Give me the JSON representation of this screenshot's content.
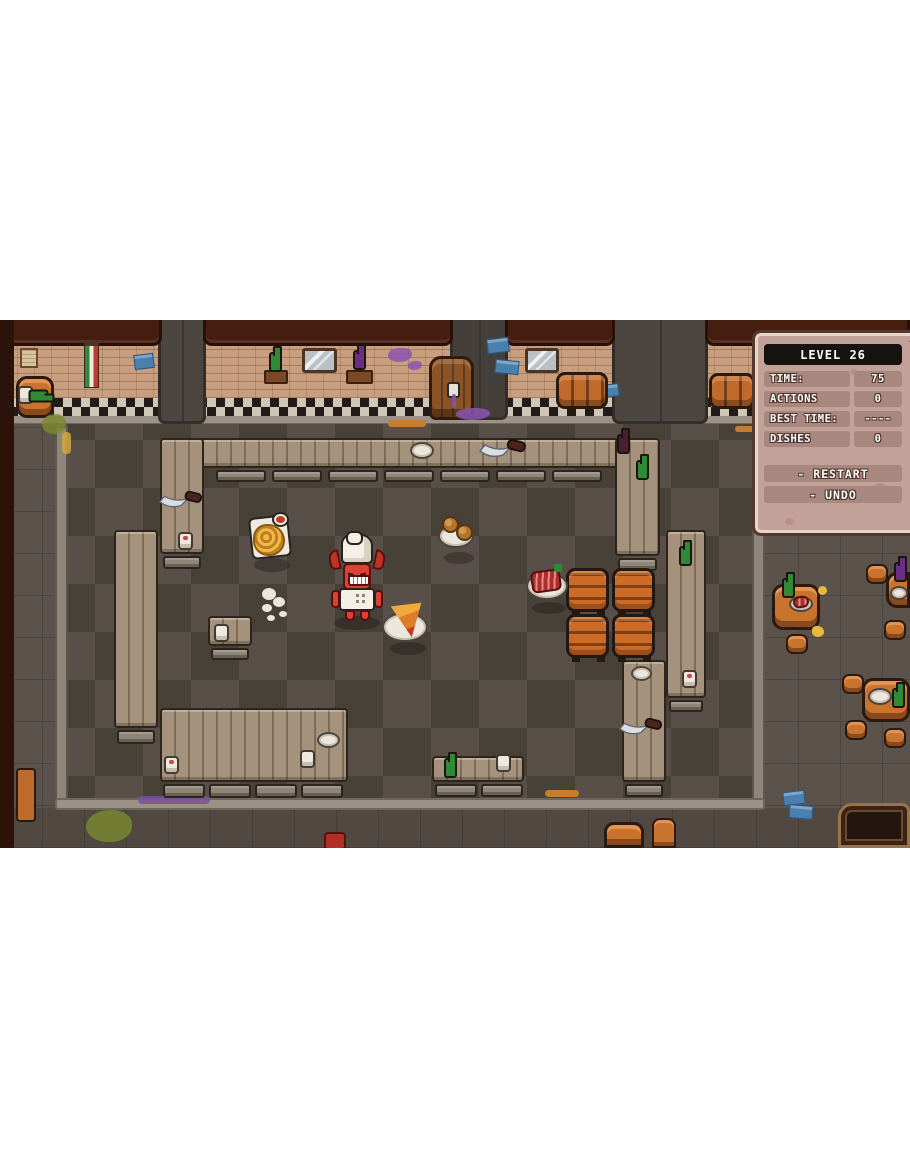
{
  "hud": {
    "level_label": "LEVEL 26",
    "rows": [
      {
        "label": "TIME:",
        "value": "75"
      },
      {
        "label": "ACTIONS",
        "value": "0"
      },
      {
        "label": "BEST TIME:",
        "value": "----"
      },
      {
        "label": "DISHES",
        "value": "0"
      }
    ],
    "buttons": [
      {
        "label": "- RESTART"
      },
      {
        "label": "- UNDO"
      }
    ]
  },
  "scene": {
    "setting": "pixel-art restaurant kitchen, top-down view",
    "player": "devil-chef with white chef hat and apron",
    "dishes_on_floor": [
      "fries-tray with sauce cup",
      "meatball-plate",
      "pizza-slice-plate",
      "ribs-plate with garnish"
    ],
    "wall_props": [
      "italian-flag",
      "two-windows",
      "wine-barrel with spigot",
      "two-lying-barrels",
      "purple-bottle-shelf",
      "green-bottle-shelf",
      "paper-stack",
      "blue-notes",
      "purple-splats"
    ],
    "props": {
      "storage_barrels": 4,
      "knives": 4,
      "plates": 5,
      "cups": 7,
      "bottles": 8,
      "dining_tables": 4,
      "stools": 8,
      "steam_puff": 1
    }
  },
  "colors": {
    "letterbox": "#ffffff",
    "panel_bg": "#c2a198",
    "panel_pill": "#a8877f",
    "panel_title_bg": "#16120f",
    "hud_text": "#ffffff",
    "floor_tile_light": "#574f48",
    "floor_tile_dark": "#474138",
    "counter_wood": "#a5927d",
    "barrel_orange": "#cc6a26",
    "brick_wall": "#c79e7e",
    "devil_red": "#d84334"
  }
}
